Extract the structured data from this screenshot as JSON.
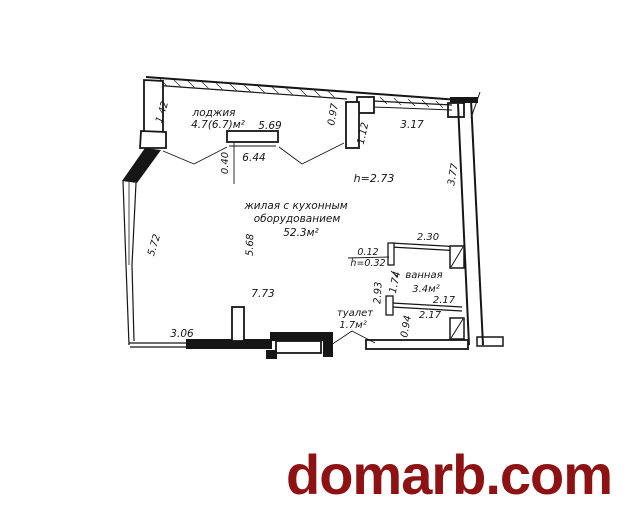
{
  "plan": {
    "loggia_label": "лоджия",
    "loggia_area": "4.7(6.7)м²",
    "living_label_1": "жилая с кухонным",
    "living_label_2": "оборудованием",
    "living_area": "52.3м²",
    "bath_label": "ванная",
    "bath_area": "3.4м²",
    "toilet_label": "туалет",
    "toilet_area": "1.7м²",
    "ceiling_height": "h=2.73",
    "niche_height": "h=0.32",
    "dims": {
      "d569": "5.69",
      "d644": "6.44",
      "d040": "0.40",
      "d142": "1.42",
      "d097": "0.97",
      "d112": "1.12",
      "d317": "3.17",
      "d377": "3.77",
      "d572": "5.72",
      "d568": "5.68",
      "d773": "7.73",
      "d306": "3.06",
      "d230": "2.30",
      "d012": "0.12",
      "d174": "1.74",
      "d293": "2.93",
      "d217a": "2.17",
      "d217b": "2.17",
      "d094": "0.94"
    }
  },
  "watermark": {
    "text": "domarb.com",
    "color": "#8e1113"
  }
}
